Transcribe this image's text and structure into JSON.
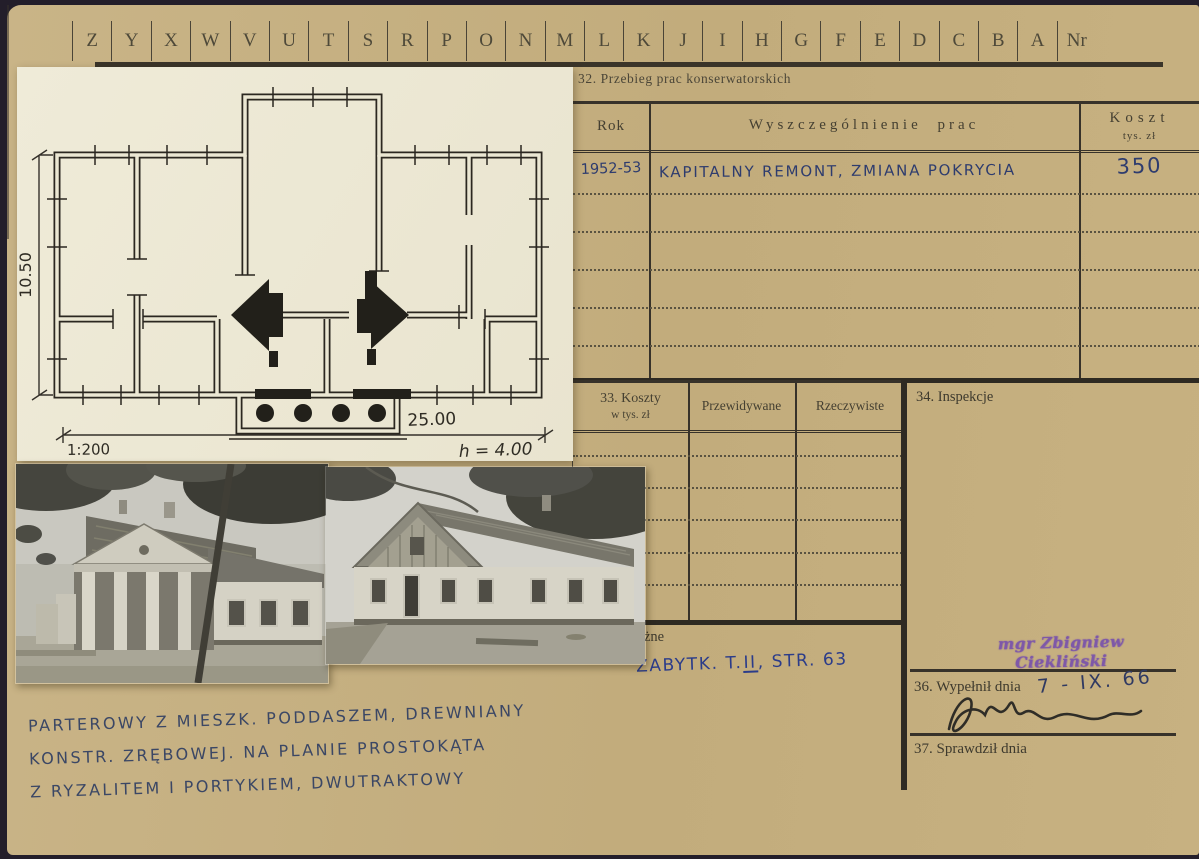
{
  "index_strip": {
    "letters": [
      "Z",
      "Y",
      "X",
      "W",
      "V",
      "U",
      "T",
      "S",
      "R",
      "P",
      "O",
      "N",
      "M",
      "L",
      "K",
      "J",
      "I",
      "H",
      "G",
      "F",
      "E",
      "D",
      "C",
      "B",
      "A"
    ],
    "nr_label": "Nr"
  },
  "section32": {
    "title": "32. Przebieg prac konserwatorskich",
    "col_rok": "Rok",
    "col_prace": "Wyszczególnienie prac",
    "col_koszt": "Koszt",
    "col_koszt_unit": "tys. zł",
    "entry": {
      "rok": "1952-53",
      "prace": "KAPITALNY REMONT, ZMIANA POKRYCIA",
      "koszt": "350"
    }
  },
  "section33": {
    "title": "33. Koszty",
    "subtitle": "w tys. zł",
    "col_przewidywane": "Przewidywane",
    "col_rzeczywiste": "Rzeczywiste"
  },
  "section34": {
    "title": "34. Inspekcje",
    "stamp_text": "mgr Zbigniew Ciekliński"
  },
  "section35": {
    "visible_label": "gi różne",
    "note_prefix": "ZABYTK. T.",
    "note_roman": "II",
    "note_suffix": ", STR. 63"
  },
  "section36": {
    "label": "36. Wypełnił dnia",
    "date": "7 - IX. 66"
  },
  "section37": {
    "label": "37. Sprawdził dnia"
  },
  "plan": {
    "dim_height": "10.50",
    "dim_width": "25.00",
    "scale": "1:200",
    "building_height": "h = 4.00"
  },
  "description": {
    "line1": "PARTEROWY Z MIESZK. PODDASZEM, DREWNIANY",
    "line2": "KONSTR. ZRĘBOWEJ. NA PLANIE PROSTOKĄTA",
    "line3": "Z RYZALITEM I PORTYKIEM, DWUTRAKTOWY"
  },
  "colors": {
    "card": "#c5b083",
    "paper": "#ece8d4",
    "ink": "#37322a",
    "handwriting_blue": "#2e3c6e",
    "note_blue": "#2b3c8a",
    "stamp_purple": "#7e58a8",
    "edge_dark": "#231e2a"
  }
}
